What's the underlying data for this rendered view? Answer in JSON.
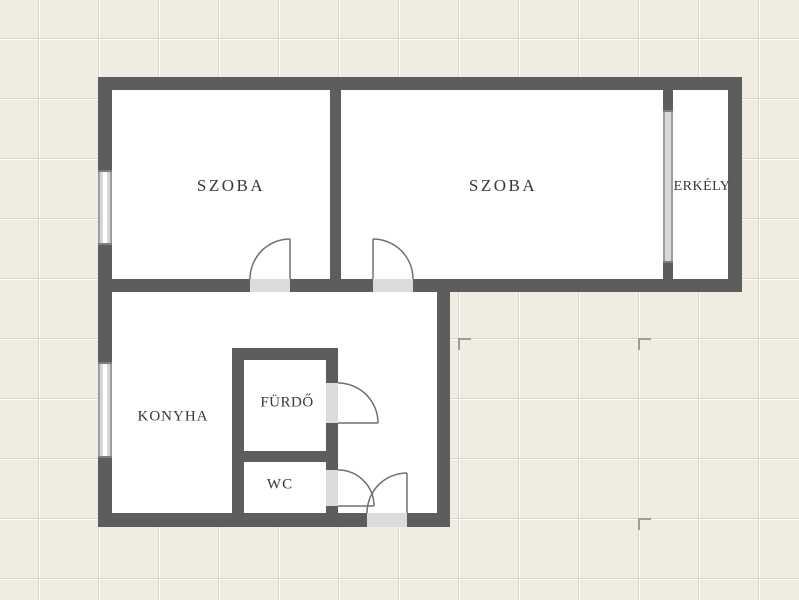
{
  "plan": {
    "type": "apartment-floorplan",
    "language": "Hungarian",
    "rooms": [
      {
        "id": "szoba-1",
        "label": "SZOBA"
      },
      {
        "id": "szoba-2",
        "label": "SZOBA"
      },
      {
        "id": "erkely",
        "label": "ERKÉLY"
      },
      {
        "id": "konyha",
        "label": "KONYHA"
      },
      {
        "id": "furdo",
        "label": "FÜRDŐ"
      },
      {
        "id": "wc",
        "label": "WC"
      }
    ],
    "features": {
      "window_count": 3,
      "door_count": 5
    },
    "colors": {
      "background": "#f1ece2",
      "grid_line": "#e2dccd",
      "wall": "#5d5d5d",
      "room_fill": "#ffffff",
      "door_threshold": "#dbdbdb",
      "door_swing_line": "#707070",
      "window_fill": "#ffffff",
      "label_text": "#36363e"
    }
  }
}
